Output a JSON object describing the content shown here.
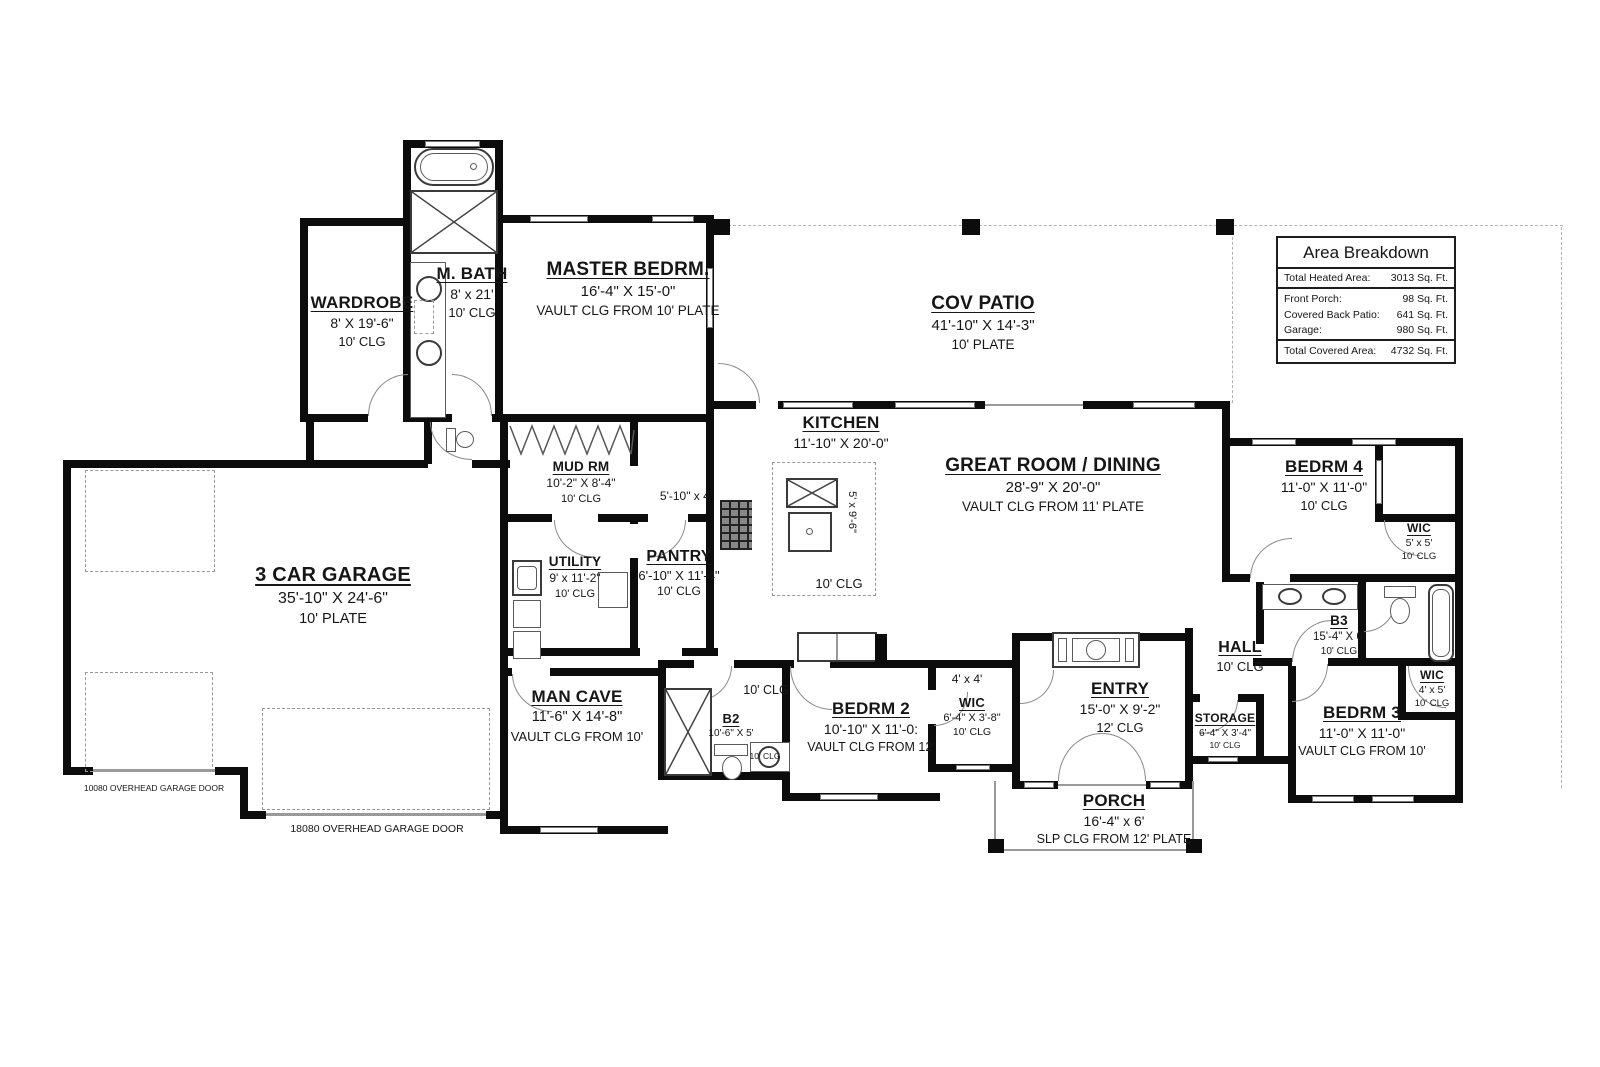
{
  "area_breakdown": {
    "title": "Area Breakdown",
    "rows": [
      {
        "label": "Total Heated Area:",
        "value": "3013 Sq. Ft."
      },
      {
        "label": "Front Porch:",
        "value": "98 Sq. Ft."
      },
      {
        "label": "Covered Back Patio:",
        "value": "641 Sq. Ft."
      },
      {
        "label": "Garage:",
        "value": "980 Sq. Ft."
      },
      {
        "label": "Total Covered Area:",
        "value": "4732 Sq. Ft."
      }
    ]
  },
  "rooms": {
    "wardrobe": {
      "name": "WARDROBE",
      "dim": "8' X 19'-6\"",
      "clg": "10' CLG"
    },
    "m_bath": {
      "name": "M. BATH",
      "dim": "8' x 21'",
      "clg": "10' CLG"
    },
    "master": {
      "name": "MASTER BEDRM.",
      "dim": "16'-4\" X 15'-0\"",
      "clg": "VAULT CLG FROM 10' PLATE"
    },
    "cov_patio": {
      "name": "COV PATIO",
      "dim": "41'-10\" X 14'-3\"",
      "clg": "10' PLATE"
    },
    "kitchen": {
      "name": "KITCHEN",
      "dim": "11'-10\" X 20'-0\"",
      "clg": "10' CLG"
    },
    "island": {
      "dim": "5' x 9'-6\""
    },
    "great_room": {
      "name": "GREAT ROOM / DINING",
      "dim": "28'-9\" X 20'-0\"",
      "clg": "VAULT CLG FROM 11' PLATE"
    },
    "bedrm4": {
      "name": "BEDRM 4",
      "dim": "11'-0\" X 11'-0\"",
      "clg": "10' CLG"
    },
    "wic4": {
      "name": "WIC",
      "dim": "5' x 5'",
      "clg": "10' CLG"
    },
    "garage": {
      "name": "3 CAR GARAGE",
      "dim": "35'-10\" X 24'-6\"",
      "clg": "10' PLATE"
    },
    "mud_rm": {
      "name": "MUD RM",
      "dim": "10'-2\" X 8'-4\"",
      "clg": "10' CLG"
    },
    "hall_niche": {
      "dim": "5'-10\" x 4'"
    },
    "utility": {
      "name": "UTILITY",
      "dim": "9' x 11'-2\"",
      "clg": "10' CLG"
    },
    "pantry": {
      "name": "PANTRY",
      "dim": "6'-10\" X 11'-4\"",
      "clg": "10' CLG"
    },
    "center_hall": {
      "clg": "10' CLG"
    },
    "man_cave": {
      "name": "MAN CAVE",
      "dim": "11'-6\" X 14'-8\"",
      "clg": "VAULT CLG FROM 10'"
    },
    "b2": {
      "name": "B2",
      "dim": "10'-6\" X 5'",
      "clg": "10' CLG"
    },
    "bedrm2": {
      "name": "BEDRM 2",
      "dim": "10'-10\" X 11'-0:",
      "clg": "VAULT CLG FROM 12'"
    },
    "closet_4x4": {
      "dim": "4' x 4'"
    },
    "wic2": {
      "name": "WIC",
      "dim": "6'-4\" X 3'-8\"",
      "clg": "10' CLG"
    },
    "entry": {
      "name": "ENTRY",
      "dim": "15'-0\" X 9'-2\"",
      "clg": "12' CLG"
    },
    "porch": {
      "name": "PORCH",
      "dim": "16'-4\" x 6'",
      "clg": "SLP CLG FROM 12' PLATE"
    },
    "hall": {
      "name": "HALL",
      "clg": "10' CLG"
    },
    "storage": {
      "name": "STORAGE",
      "dim": "6'-4\" X 3'-4\"",
      "clg": "10' CLG"
    },
    "b3": {
      "name": "B3",
      "dim": "15'-4\" X 6'",
      "clg": "10' CLG"
    },
    "bedrm3": {
      "name": "BEDRM 3",
      "dim": "11'-0\" X 11'-0\"",
      "clg": "VAULT CLG FROM 10'"
    },
    "wic3": {
      "name": "WIC",
      "dim": "4' x 5'",
      "clg": "10' CLG"
    }
  },
  "annotations": {
    "garage_door_10080": "10080 OVERHEAD GARAGE DOOR",
    "garage_door_18080": "18080 OVERHEAD GARAGE DOOR"
  }
}
